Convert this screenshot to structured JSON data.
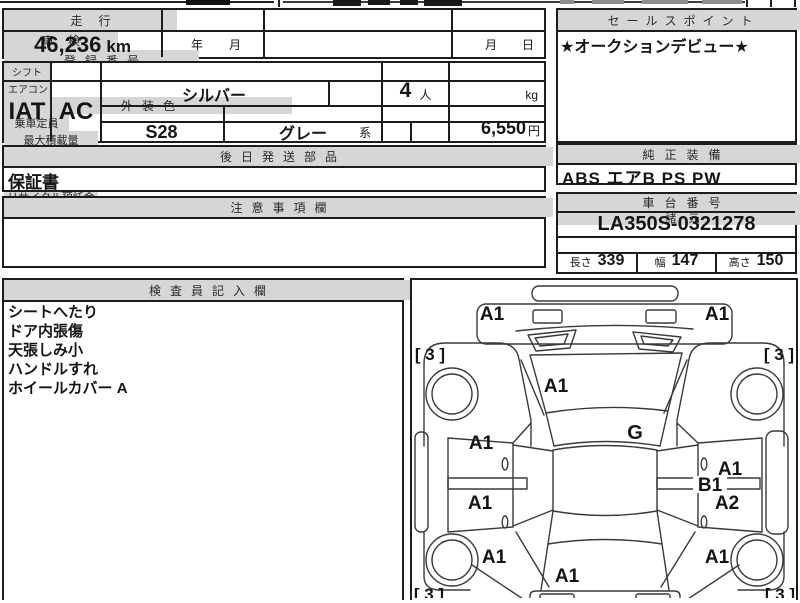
{
  "vehicle": {
    "mileage": {
      "label": "走行",
      "value": "46,236",
      "unit": "km"
    },
    "inspection": {
      "label": "車検",
      "year": "年",
      "month": "月"
    },
    "registration": {
      "label": "登録番号",
      "value": ""
    },
    "transfer_deadline": {
      "label": "譲渡書類期限",
      "month": "月",
      "day": "日"
    },
    "shift": {
      "label": "シフト",
      "value": "IAT"
    },
    "aircon": {
      "label": "エアコン",
      "value": "AC"
    },
    "exterior_color": {
      "label": "外装色",
      "value": "シルバー"
    },
    "color_no": {
      "label": "カラーNo.",
      "value": "S28"
    },
    "interior_color": {
      "label": "内装色",
      "value": "グレー",
      "suffix": "系"
    },
    "capacity": {
      "label": "乗車定員",
      "value": "4",
      "unit": "人"
    },
    "max_load": {
      "label": "最大積載量",
      "value": "",
      "unit": "kg"
    },
    "import_car": {
      "label": "輸入車",
      "value": ""
    },
    "recycle_deposit": {
      "label": "リサイクル預託金",
      "value": "6,550",
      "unit": "円"
    },
    "later_parts": {
      "label": "後日発送部品",
      "value": "保証書"
    },
    "notes": {
      "label": "注意事項欄",
      "value": ""
    }
  },
  "sales_point": {
    "label": "セールスポイント",
    "value": "★オークションデビュー★"
  },
  "equipment": {
    "label": "純正装備",
    "value": "ABS エアB PS PW"
  },
  "chassis": {
    "label": "車台番号",
    "value": "LA350S-0321278"
  },
  "specs": {
    "label": "諸元",
    "length_label": "長さ",
    "length": "339",
    "width_label": "幅",
    "width": "147",
    "height_label": "高さ",
    "height": "150"
  },
  "inspector": {
    "label": "検査員記入欄",
    "lines": [
      "シートへたり",
      "ドア内張傷",
      "天張しみ小",
      "ハンドルすれ",
      "ホイールカバー A"
    ]
  },
  "diagram": {
    "labels": {
      "front_left": "A1",
      "front_right": "A1",
      "corner_front_left": "[ 3 ]",
      "corner_front_right": "[ 3 ]",
      "hood": "A1",
      "windshield_glass": "G",
      "front_door_left": "A1",
      "rear_door_left": "A1",
      "front_door_right": "A1",
      "side_molding_right": "B1",
      "rear_door_right": "A2",
      "quarter_left": "A1",
      "quarter_right": "A1",
      "rear_panel": "A1",
      "corner_rear_left": "[ 3 ]",
      "corner_rear_right": "[ 3 ]"
    }
  }
}
